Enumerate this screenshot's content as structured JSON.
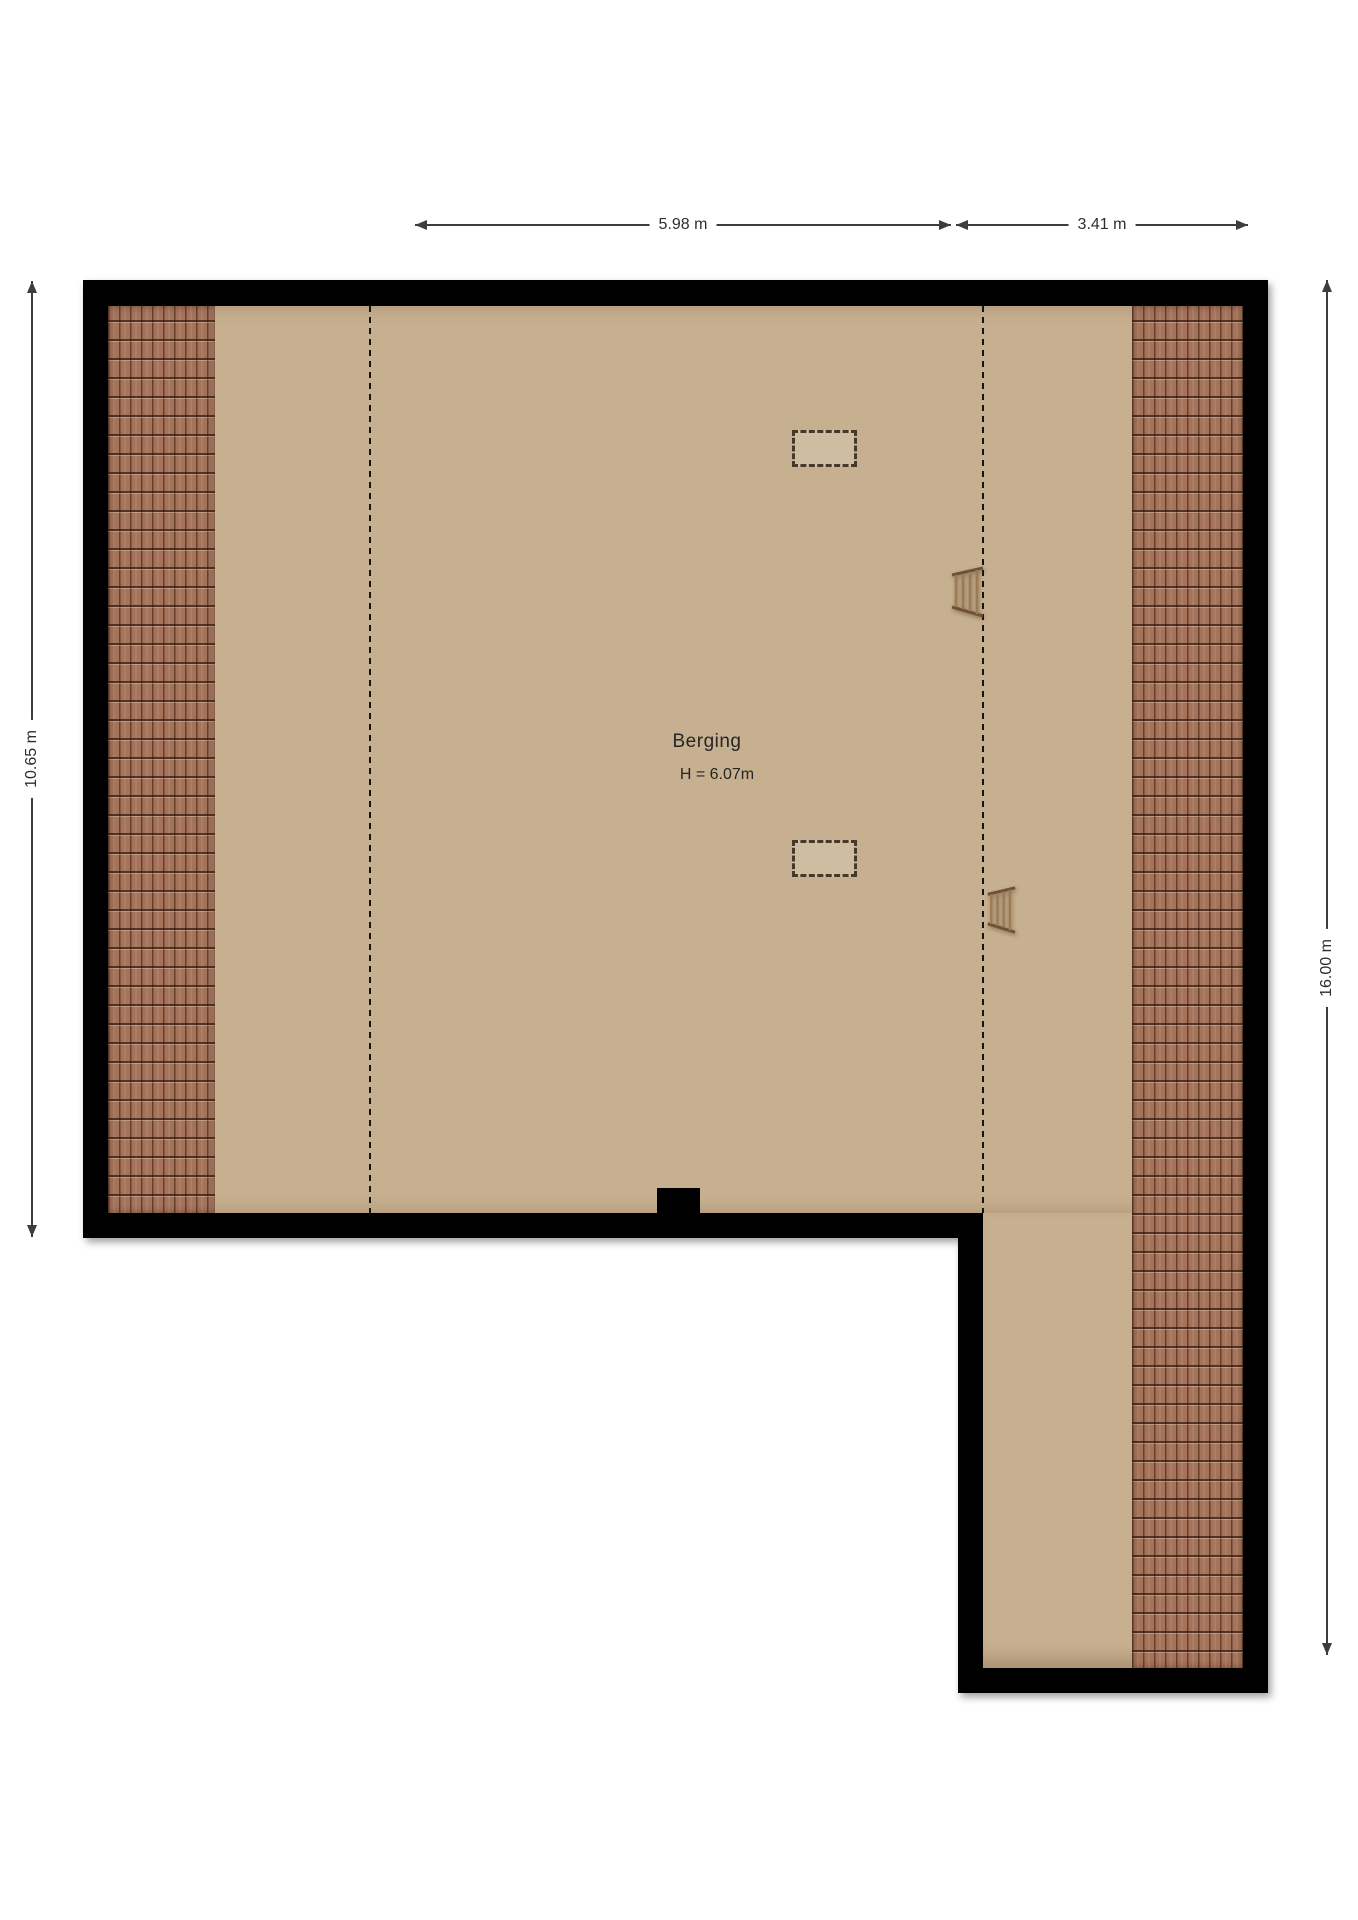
{
  "room": {
    "name": "Berging",
    "height_text": "H = 6.07m"
  },
  "dimensions": {
    "top_main": "5.98 m",
    "top_wing": "3.41 m",
    "left": "10.65 m",
    "right": "16.00 m"
  },
  "colors": {
    "wall": "#000000",
    "floor": "#c7b08f",
    "roof_tile": "#a5735a",
    "dimension_line": "#3d3d3d"
  }
}
